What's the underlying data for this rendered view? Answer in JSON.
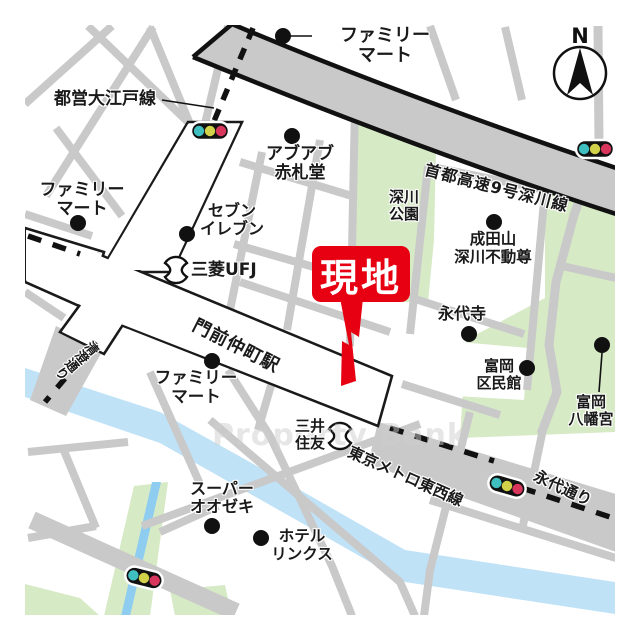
{
  "map_title": "門前仲町駅周辺案内図",
  "compass": {
    "label": "N"
  },
  "watermark": "Property Bank",
  "site_marker": {
    "label": "現地",
    "color": "#e60012"
  },
  "labels": {
    "oedo_line": "都営大江戸線",
    "familymart_north": "ファミリー\nマート",
    "abuabu_akafudado": "アブアブ\n赤札堂",
    "familymart_west": "ファミリー\nマート",
    "seven_eleven": "セブン\nイレブン",
    "mitsubishi_ufj": "三菱UFJ",
    "fukagawa_park": "深川\n公園",
    "shuto_expressway": "首都高速9号深川線",
    "narita_san": "成田山\n深川不動尊",
    "eitai_ji": "永代寺",
    "tomioka_kuminkan": "富岡\n区民館",
    "tomioka_hachimangu": "富岡\n八幡宮",
    "monzen_nakacho_station": "門前仲町駅",
    "familymart_south": "ファミリー\nマート",
    "kiyosumi_dori": "清澄通り",
    "mitsui_sumitomo": "三井\n住友",
    "super_ozeki": "スーパー\nオオゼキ",
    "hotel_links": "ホテル\nリンクス",
    "tokyo_metro_tozai": "東京メトロ東西線",
    "eitai_dori": "永代通り"
  },
  "colors": {
    "road_minor": "#c9c9c9",
    "road_main_fill": "#ffffff",
    "outline": "#1a1a1a",
    "park_green": "#d7eac6",
    "river_blue": "#bfe2f7",
    "canal_blue": "#8fcdf0",
    "accent_red": "#e60012",
    "signal_teal": "#3fbfbf",
    "signal_yellow": "#d2d24a",
    "signal_red": "#d9365e"
  }
}
